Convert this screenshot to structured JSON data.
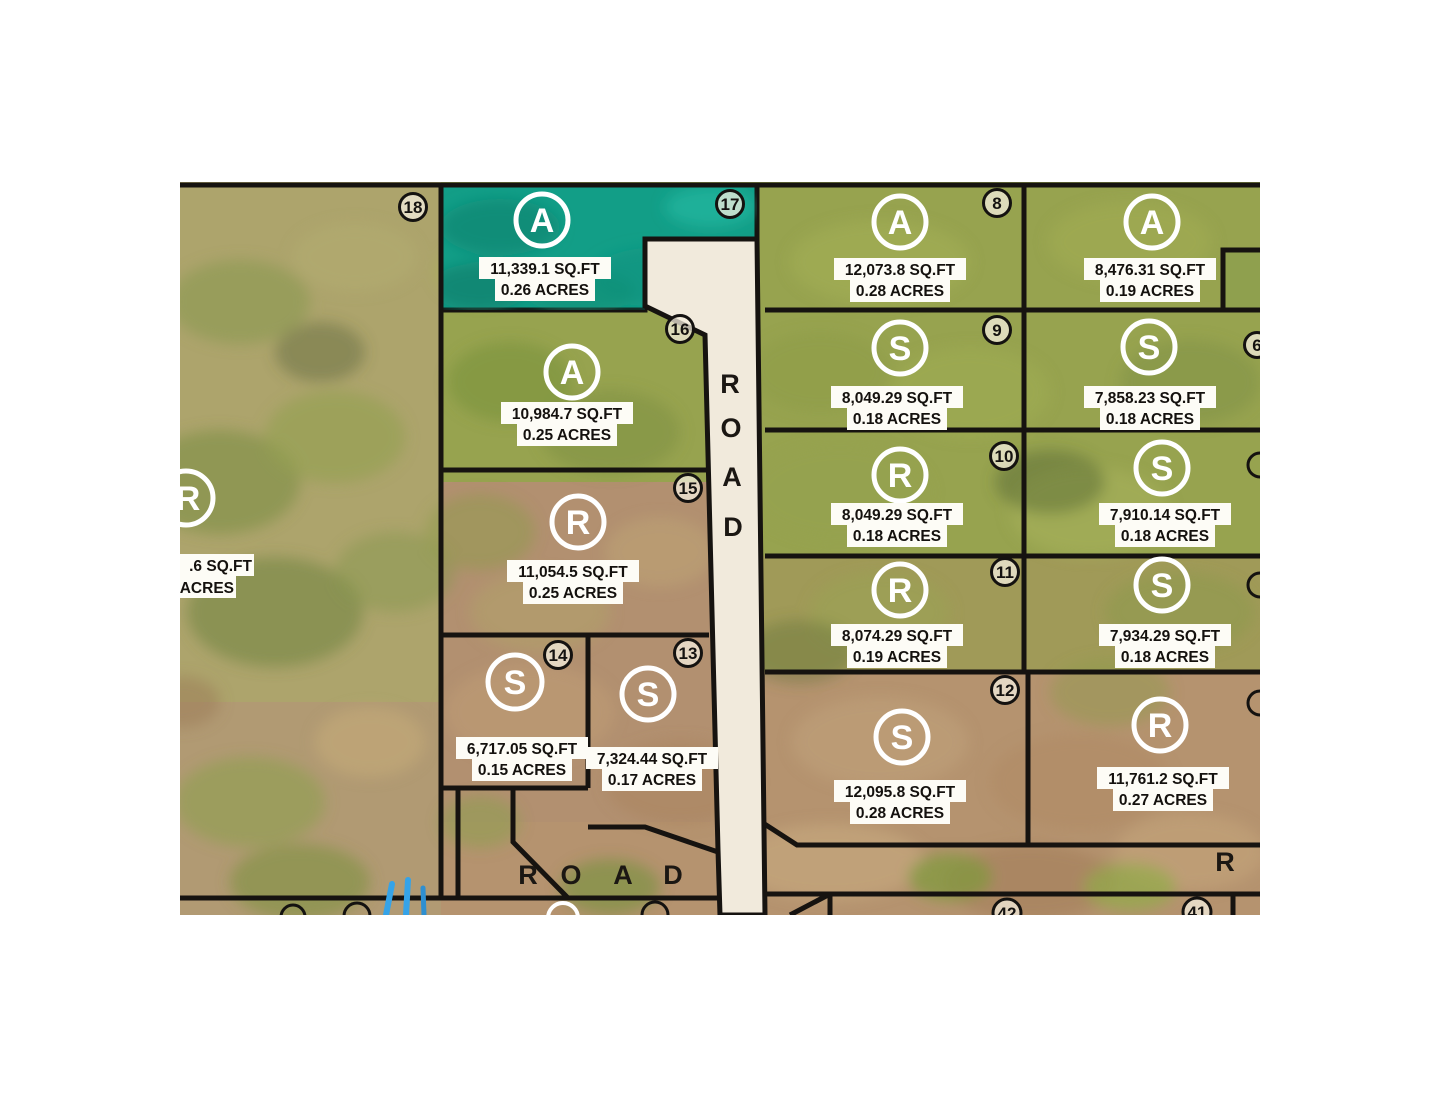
{
  "colors": {
    "teal": "#129e87",
    "teal_dark": "#0b8a74",
    "road_fill": "#f1eadc",
    "boundary_line": "#161310",
    "label_bg": "#fdfcf6",
    "marker_white": "#ffffff",
    "number_badge_bg": "#f4eedd",
    "stream_blue": "#35a3e8"
  },
  "roads": {
    "vertical": [
      "R",
      "O",
      "A",
      "D"
    ],
    "horizontal": [
      "R",
      "O",
      "A",
      "D"
    ],
    "right_partial": "R"
  },
  "lots": {
    "l18": {
      "number": "18"
    },
    "l17": {
      "number": "17",
      "letter": "A",
      "sqft": "11,339.1 SQ.FT",
      "acres": "0.26 ACRES"
    },
    "l16": {
      "number": "16",
      "letter": "A",
      "sqft": "10,984.7 SQ.FT",
      "acres": "0.25 ACRES"
    },
    "l15": {
      "number": "15",
      "letter": "R",
      "sqft": "11,054.5 SQ.FT",
      "acres": "0.25 ACRES"
    },
    "l14": {
      "number": "14",
      "letter": "S",
      "sqft": "6,717.05 SQ.FT",
      "acres": "0.15 ACRES"
    },
    "l13": {
      "number": "13",
      "letter": "S",
      "sqft": "7,324.44 SQ.FT",
      "acres": "0.17 ACRES"
    },
    "l8": {
      "number": "8",
      "letter": "A",
      "sqft": "12,073.8 SQ.FT",
      "acres": "0.28 ACRES"
    },
    "l9": {
      "number": "9",
      "letter": "S",
      "sqft": "8,049.29 SQ.FT",
      "acres": "0.18 ACRES"
    },
    "l10": {
      "number": "10",
      "letter": "R",
      "sqft": "8,049.29 SQ.FT",
      "acres": "0.18 ACRES"
    },
    "l11": {
      "number": "11",
      "letter": "R",
      "sqft": "8,074.29 SQ.FT",
      "acres": "0.19 ACRES"
    },
    "l12": {
      "number": "12",
      "letter": "S",
      "sqft": "12,095.8 SQ.FT",
      "acres": "0.28 ACRES"
    },
    "r1": {
      "letter": "A",
      "sqft": "8,476.31 SQ.FT",
      "acres": "0.19 ACRES"
    },
    "r2": {
      "number": "6",
      "letter": "S",
      "sqft": "7,858.23 SQ.FT",
      "acres": "0.18 ACRES"
    },
    "r3": {
      "letter": "S",
      "sqft": "7,910.14 SQ.FT",
      "acres": "0.18 ACRES"
    },
    "r4": {
      "letter": "S",
      "sqft": "7,934.29 SQ.FT",
      "acres": "0.18 ACRES"
    },
    "r5": {
      "letter": "R",
      "sqft": "11,761.2 SQ.FT",
      "acres": "0.27 ACRES"
    },
    "left_partial": {
      "letter": "R",
      "sqft": ".6 SQ.FT",
      "acres": "ACRES"
    },
    "b42": {
      "number": "42"
    },
    "b41": {
      "number": "41"
    }
  }
}
